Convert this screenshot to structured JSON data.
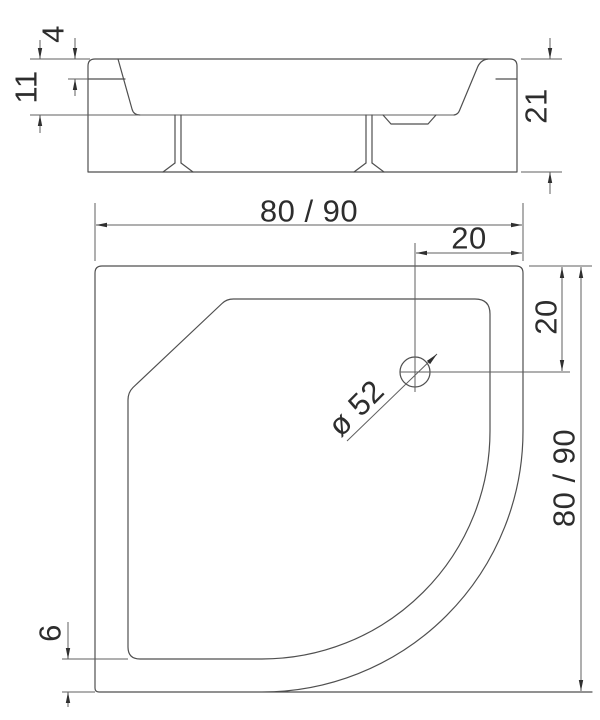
{
  "page": {
    "background": "#ffffff",
    "line_color": "#4f4f4f",
    "dim_line_color": "#5f5f5f",
    "text_color": "#2d2d2d"
  },
  "drawing": {
    "kind": "technical-dimension-drawing",
    "subject": "quadrant shower tray",
    "views": {
      "side": {
        "name": "side section view",
        "dimensions": {
          "rim_step": "4",
          "rim_height": "11",
          "total_height": "21"
        }
      },
      "plan": {
        "name": "top plan view",
        "dimensions": {
          "overall_width": "80 / 90",
          "drain_offset_x": "20",
          "drain_offset_y": "20",
          "drain_diameter": "ø 52",
          "overall_depth": "80 / 90",
          "rim_offset": "6"
        }
      }
    }
  }
}
